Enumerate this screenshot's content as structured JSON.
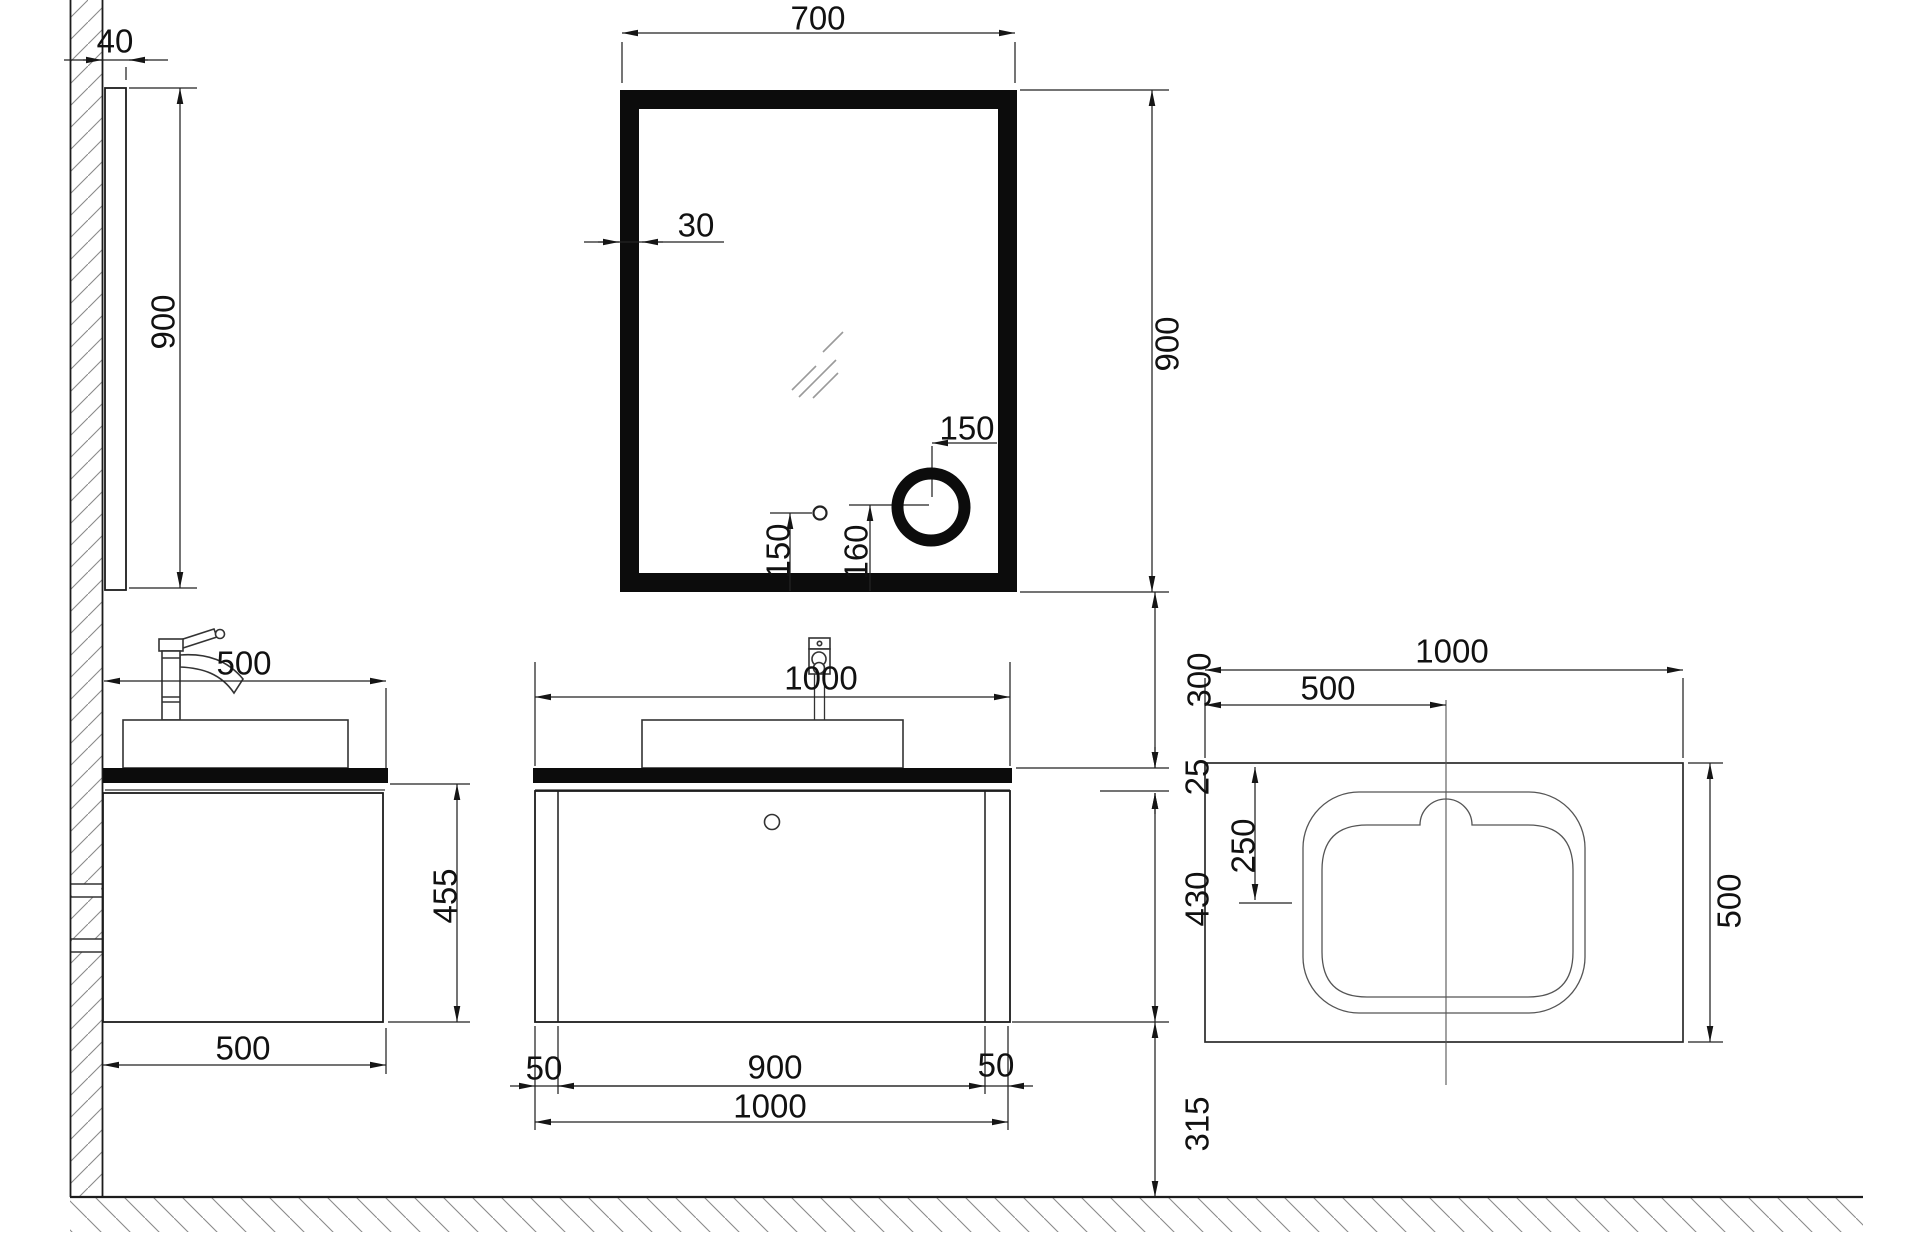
{
  "document": {
    "type": "CAD technical drawing",
    "subject": "Bathroom vanity, LED mirror and basin installation dimensions",
    "units": "mm"
  },
  "views": {
    "mirror_side": {
      "depth": "40",
      "height": "900"
    },
    "mirror_front": {
      "width": "700",
      "frame_thickness": "30",
      "height": "900",
      "magnifier_offset_right": "150",
      "switch_height": "150",
      "magnifier_height": "160"
    },
    "vanity_side": {
      "top_depth": "500",
      "body_height": "455",
      "bottom_depth": "500"
    },
    "vanity_front": {
      "top_width": "1000",
      "left_inset": "50",
      "body_width": "900",
      "right_inset": "50",
      "total_width": "1000"
    },
    "height_chain": {
      "mirror_to_counter": "300",
      "counter_thickness": "25",
      "cabinet_height": "430",
      "under_clearance": "315"
    },
    "counter_plan": {
      "width": "1000",
      "center_offset": "500",
      "basin_center_offset": "250",
      "depth": "500"
    }
  },
  "colors": {
    "line": "#1c1c1c",
    "dim": "#222222",
    "hatch": "#8a8a8a",
    "fill_solid": "#0c0c0c"
  }
}
